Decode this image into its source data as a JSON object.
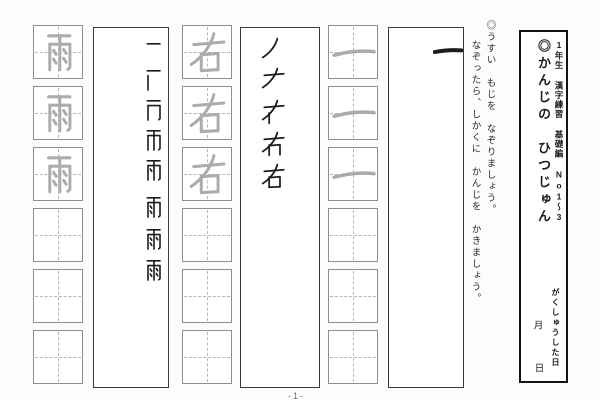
{
  "header_box": {
    "series_label": "1年生 漢字練習 基礎編 No1～3",
    "title": "◎かんじの　ひつじゅん",
    "study_date_label": "がくしゅうした日",
    "month_label": "月",
    "day_label": "日"
  },
  "instructions": {
    "line1": "◎うすい　もじを　なぞりましょう。",
    "line2": "なぞったら、しかくに　かんじを　かきましょう。"
  },
  "practice_columns": [
    {
      "kanji": "一",
      "order_steps": [
        "一"
      ],
      "traced_cells": [
        "一",
        "一",
        "一"
      ],
      "empty_cell_count": 3,
      "cells_total": 6
    },
    {
      "kanji": "右",
      "order_steps": [
        "ノ",
        "ナ",
        "ナ+丨",
        "ナ+丨+𠃍",
        "右"
      ],
      "traced_cells": [
        "右",
        "右",
        "右"
      ],
      "empty_cell_count": 3,
      "cells_total": 6
    },
    {
      "kanji": "雨",
      "order_steps": [
        "一",
        "一+丨",
        "一+丨+𠃌",
        "帀",
        "帀+丶",
        "雨(6画)",
        "雨(7画)",
        "雨"
      ],
      "traced_cells": [
        "雨",
        "雨",
        "雨"
      ],
      "empty_cell_count": 3,
      "cells_total": 6
    }
  ],
  "page_number": "-1-",
  "colors": {
    "ink": "#1d1d1d",
    "trace_gray": "#acacac",
    "cell_border": "#8d8d8d",
    "guide_dash": "#b6b6b6",
    "header_border": "#141414"
  }
}
